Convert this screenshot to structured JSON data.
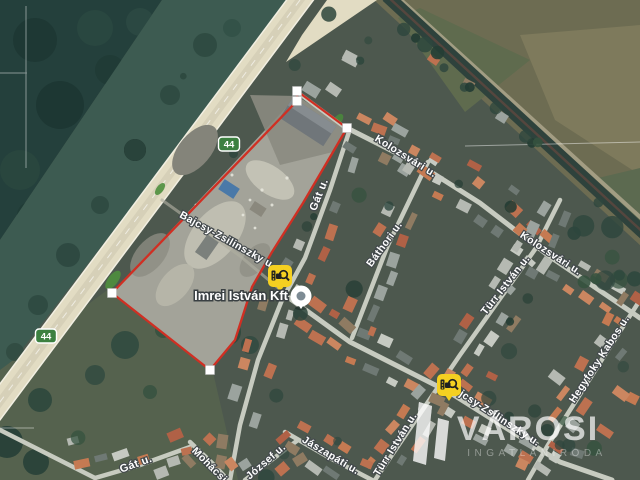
{
  "map_type": "satellite",
  "route_shields": [
    {
      "label": "44"
    },
    {
      "label": "44"
    }
  ],
  "street_labels": [
    {
      "text": "Bajcsy-Zsilinszky u."
    },
    {
      "text": "Gát u."
    },
    {
      "text": "Kolozsvári u."
    },
    {
      "text": "Báthori u."
    },
    {
      "text": "Kolozsvári u."
    },
    {
      "text": "Türr István u."
    },
    {
      "text": "Hegyfoky Kabos u."
    },
    {
      "text": "Türr István u."
    },
    {
      "text": "Bajcsy-Zsilinszky u."
    },
    {
      "text": "Jászapáti u."
    },
    {
      "text": "Mohácsi u."
    },
    {
      "text": "József u."
    },
    {
      "text": "Gát u."
    }
  ],
  "business": {
    "name": "Imrei István Kft"
  },
  "watermark": {
    "brand": "VÁROSI",
    "tagline": "INGATLANIRODA"
  },
  "colors": {
    "boundary_red": "#d02f23",
    "shield_green": "#3c8040",
    "marker_yellow": "#f5d021",
    "highway_beige": "#e2dcc3"
  }
}
